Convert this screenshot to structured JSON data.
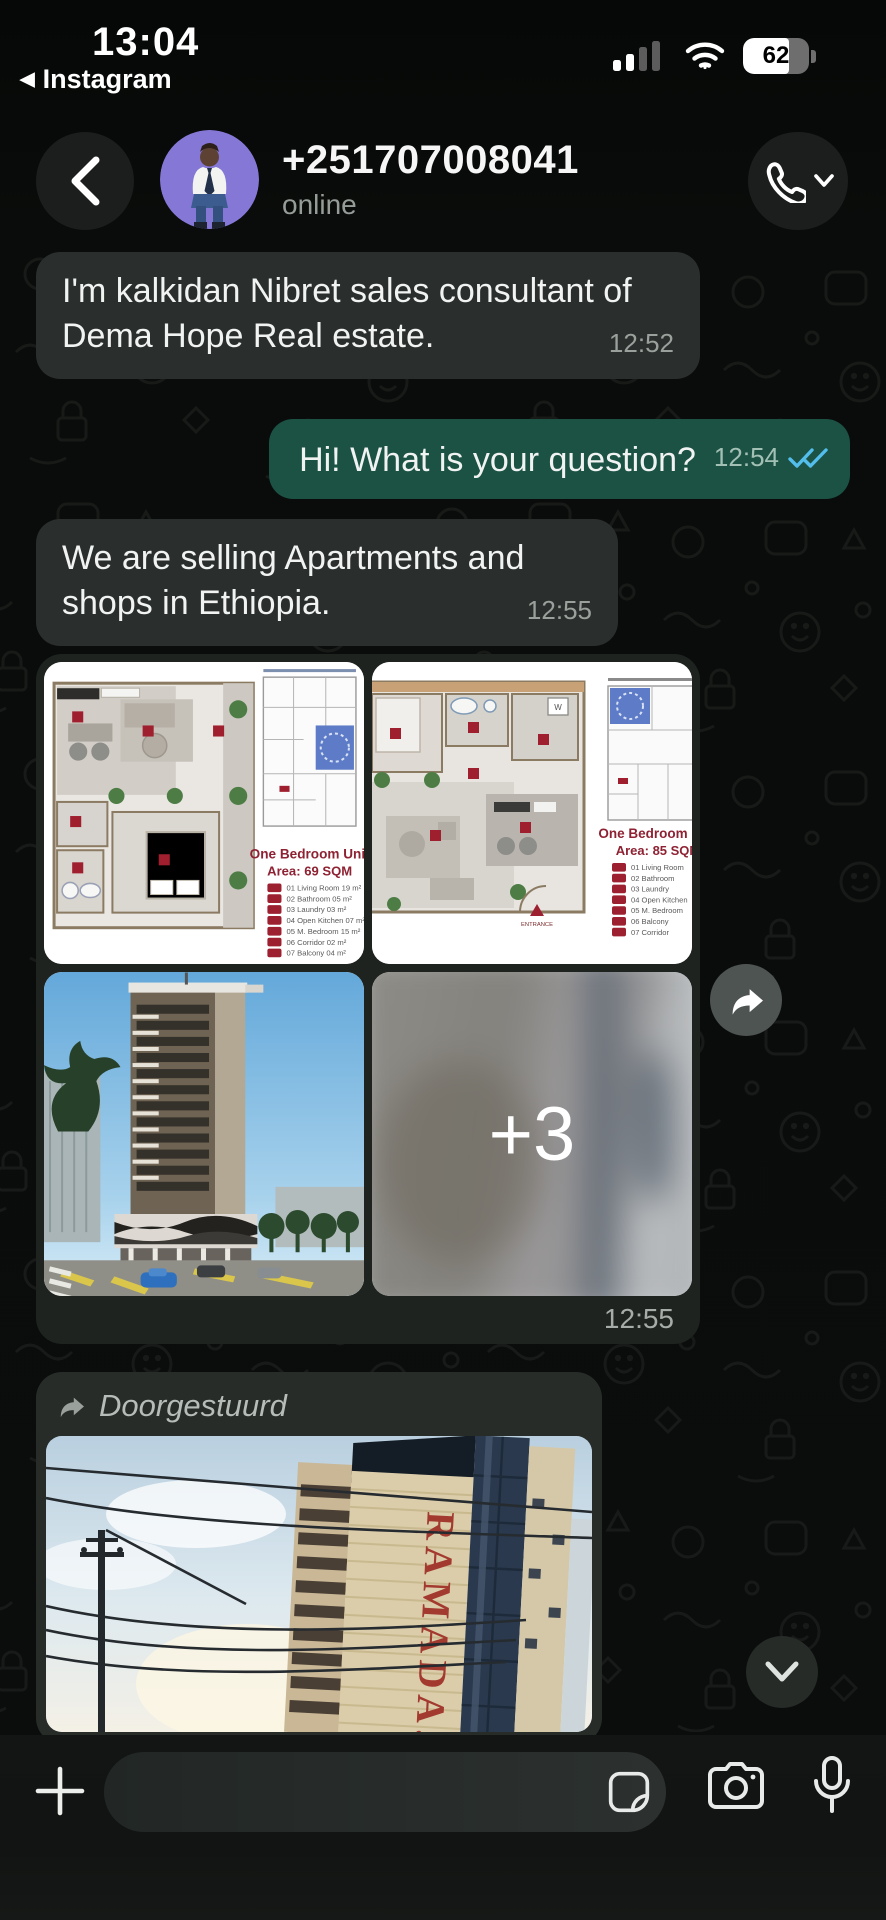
{
  "status_bar": {
    "time": "13:04",
    "back_app": "Instagram",
    "battery_percent": "62"
  },
  "header": {
    "title": "+251707008041",
    "subtitle": "online"
  },
  "chat": {
    "msg1": {
      "text": "I'm kalkidan Nibret sales consultant of Dema Hope Real estate.",
      "time": "12:52"
    },
    "msg2": {
      "text": "Hi! What is your question?",
      "time": "12:54"
    },
    "msg3": {
      "text": "We are selling Apartments and shops in Ethiopia.",
      "time": "12:55"
    },
    "album": {
      "time": "12:55",
      "more_overlay": "+3"
    },
    "forwarded": {
      "label": "Doorgestuurd",
      "image_sign": "RAMADA."
    }
  },
  "plan1": {
    "title1": "One Bedroom Unit",
    "title2": "Area: 69 SQM",
    "legend": [
      "01  Living Room      19 m²",
      "02  Bathroom         05 m²",
      "03  Laundry          03 m²",
      "04  Open Kitchen     07 m²",
      "05  M. Bedroom       15 m²",
      "06  Corridor         02 m²",
      "07  Balcony          04 m²"
    ]
  },
  "plan2": {
    "title1": "One Bedroom Unit",
    "title2": "Area: 85 SQM",
    "entrance_label": "ENTRANCE",
    "legend": [
      "01  Living Room",
      "02  Bathroom",
      "03  Laundry",
      "04  Open Kitchen",
      "05  M. Bedroom",
      "06  Balcony",
      "07  Corridor"
    ]
  },
  "composer": {
    "input_value": ""
  },
  "icons": {
    "back": "chevron-left",
    "call": "phone",
    "call_more": "chevron-down",
    "read_receipt": "double-check",
    "forward": "share-arrow",
    "forwarded_label": "forward-arrow",
    "scroll_down": "chevron-down",
    "attach": "plus",
    "sticker": "sticker-square",
    "camera": "camera",
    "voice": "microphone",
    "signal": "cellular-bars",
    "wifi": "wifi-arcs",
    "battery": "battery-pill"
  }
}
